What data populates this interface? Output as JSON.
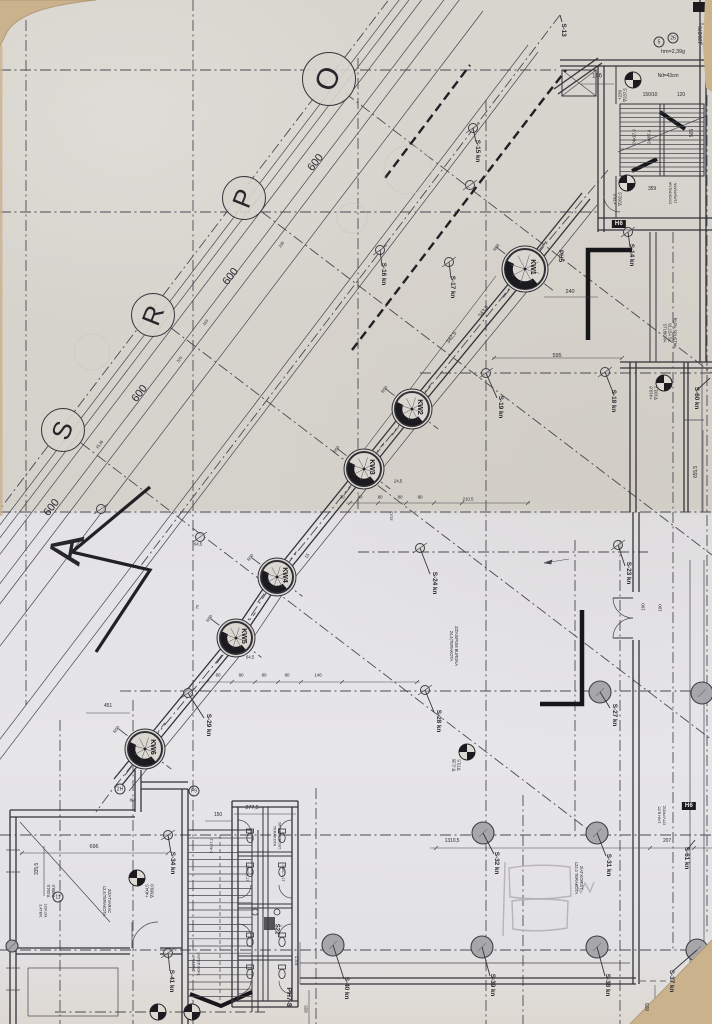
{
  "meta": {
    "sheet": "Scanned architectural working drawing – floor plan with diagonal colonnade"
  },
  "colors": {
    "paper_top": "#d6d3cc",
    "paper_bottom": "#e3e2e5",
    "cardboard": "#c9b28c",
    "ink": "#33333a",
    "ink_light": "#4a4a52",
    "black": "#1b1b1f",
    "gray_fill": "#a7a7ab",
    "pencil": "#b2afb4"
  },
  "grid": {
    "section_letter": "A",
    "spacing_label": "600",
    "bubbles": [
      {
        "letter": "O",
        "x": 329,
        "y": 79,
        "r": 27,
        "fs": 30
      },
      {
        "letter": "P",
        "x": 244,
        "y": 198,
        "r": 22,
        "fs": 26
      },
      {
        "letter": "R",
        "x": 153,
        "y": 315,
        "r": 22,
        "fs": 26
      },
      {
        "letter": "S",
        "x": 63,
        "y": 430,
        "r": 22,
        "fs": 26
      }
    ]
  },
  "columns": [
    {
      "label": "KW1",
      "x": 525,
      "y": 269,
      "r": 23
    },
    {
      "label": "KW2",
      "x": 412,
      "y": 409,
      "r": 20
    },
    {
      "label": "KW3",
      "x": 364,
      "y": 469,
      "r": 20
    },
    {
      "label": "KW4",
      "x": 277,
      "y": 577,
      "r": 19
    },
    {
      "label": "KW5",
      "x": 236,
      "y": 638,
      "r": 19
    },
    {
      "label": "KW6",
      "x": 145,
      "y": 749,
      "r": 20
    }
  ],
  "survey_columns": [
    {
      "x": 483,
      "y": 833
    },
    {
      "x": 597,
      "y": 833
    },
    {
      "x": 482,
      "y": 947
    },
    {
      "x": 597,
      "y": 947
    },
    {
      "x": 697,
      "y": 950
    },
    {
      "x": 333,
      "y": 945
    },
    {
      "x": 600,
      "y": 692
    },
    {
      "x": 702,
      "y": 693
    },
    {
      "x": 12,
      "y": 946,
      "r": 6
    }
  ],
  "nodes": [
    [
      486,
      373
    ],
    [
      605,
      372
    ],
    [
      425,
      690
    ],
    [
      168,
      835
    ],
    [
      168,
      953
    ],
    [
      420,
      548
    ],
    [
      618,
      545
    ],
    [
      188,
      693
    ],
    [
      628,
      232
    ],
    [
      473,
      128
    ],
    [
      380,
      250
    ],
    [
      470,
      185
    ],
    [
      200,
      537
    ],
    [
      101,
      509
    ],
    [
      449,
      262
    ]
  ],
  "level_markers": [
    [
      633,
      80
    ],
    [
      627,
      183
    ],
    [
      664,
      383
    ],
    [
      467,
      752
    ],
    [
      137,
      878
    ],
    [
      158,
      1012
    ],
    [
      192,
      1012
    ],
    [
      689,
      1002
    ]
  ],
  "leaders": [
    [
      605,
      372,
      614,
      395
    ],
    [
      486,
      373,
      497,
      398
    ],
    [
      600,
      692,
      610,
      708
    ],
    [
      425,
      690,
      434,
      712
    ],
    [
      420,
      548,
      430,
      574
    ],
    [
      618,
      545,
      625,
      566
    ],
    [
      188,
      693,
      204,
      718
    ],
    [
      168,
      835,
      171,
      853
    ],
    [
      168,
      953,
      170,
      971
    ],
    [
      597,
      833,
      606,
      856
    ],
    [
      483,
      833,
      494,
      854
    ],
    [
      697,
      950,
      673,
      971
    ],
    [
      597,
      947,
      605,
      976
    ],
    [
      482,
      947,
      490,
      976
    ],
    [
      333,
      945,
      344,
      979
    ],
    [
      710,
      378,
      697,
      390
    ],
    [
      695,
      840,
      687,
      850
    ],
    [
      628,
      232,
      630,
      247
    ],
    [
      473,
      128,
      476,
      142
    ],
    [
      380,
      250,
      382,
      266
    ],
    [
      449,
      262,
      451,
      278
    ],
    [
      560,
      15,
      562,
      22
    ]
  ],
  "stairs": [
    {
      "x1": 620,
      "x2": 704,
      "y1": 108.5,
      "y2": 172,
      "step": 4.5
    },
    {
      "x1": 188,
      "x2": 252,
      "y1": 838,
      "y2": 1000,
      "step": 7.2
    }
  ],
  "fixtures": {
    "wc": [
      [
        250,
        838
      ],
      [
        282,
        838
      ],
      [
        250,
        872
      ],
      [
        282,
        872
      ],
      [
        250,
        942
      ],
      [
        282,
        942
      ],
      [
        250,
        974
      ],
      [
        282,
        974
      ]
    ],
    "sinks": [
      [
        255,
        912
      ],
      [
        277,
        912
      ]
    ]
  },
  "black_labels": [
    {
      "t": "H6",
      "x": 619,
      "y": 224
    },
    {
      "t": "H6",
      "x": 689,
      "y": 806
    }
  ],
  "circled_labels": [
    {
      "t": "5",
      "x": 659,
      "y": 42
    },
    {
      "t": "26",
      "x": 673,
      "y": 38
    },
    {
      "t": "2H",
      "x": 120,
      "y": 789
    },
    {
      "t": "F9",
      "x": 194,
      "y": 791
    },
    {
      "t": "11",
      "x": 58,
      "y": 897
    }
  ],
  "texts": [
    {
      "n": "grid-spacing",
      "t": "600",
      "x": 316,
      "y": 163,
      "r": -52,
      "s": 11
    },
    {
      "n": "grid-spacing",
      "t": "600",
      "x": 231,
      "y": 277,
      "r": -52,
      "s": 11
    },
    {
      "n": "grid-spacing",
      "t": "600",
      "x": 140,
      "y": 394,
      "r": -52,
      "s": 11
    },
    {
      "n": "grid-spacing",
      "t": "600",
      "x": 52,
      "y": 508,
      "r": -52,
      "s": 11
    },
    {
      "n": "dim",
      "t": "146",
      "x": 597,
      "y": 77,
      "r": 0,
      "s": 6
    },
    {
      "n": "dim",
      "t": "150/10",
      "x": 650,
      "y": 96,
      "r": 0,
      "s": 5
    },
    {
      "n": "dim",
      "t": "120",
      "x": 681,
      "y": 96,
      "r": 0,
      "s": 5
    },
    {
      "n": "dim",
      "t": "359",
      "x": 652,
      "y": 190,
      "r": 0,
      "s": 5
    },
    {
      "n": "dim",
      "t": "505",
      "x": 693,
      "y": 133,
      "r": -90,
      "s": 5
    },
    {
      "n": "dim",
      "t": "24x17,9",
      "x": 634,
      "y": 137,
      "r": -90,
      "s": 4.5
    },
    {
      "n": "dim",
      "t": "240/7,4",
      "x": 649,
      "y": 137,
      "r": -90,
      "s": 4.5
    },
    {
      "n": "note",
      "t": "hm=2,39g",
      "x": 673,
      "y": 52,
      "r": 0,
      "s": 5.5
    },
    {
      "n": "note",
      "t": "Nd=43cm",
      "x": 668,
      "y": 77,
      "r": 0,
      "s": 5
    },
    {
      "n": "dim",
      "t": "120/270",
      "x": 702,
      "y": 35,
      "r": -90,
      "s": 5
    },
    {
      "n": "marker-label",
      "t": "S-13",
      "x": 563,
      "y": 30,
      "r": 90,
      "s": 6.5,
      "b": 1
    },
    {
      "n": "marker-label",
      "t": "S-14 kn",
      "x": 631,
      "y": 255,
      "r": 90,
      "s": 6.5,
      "b": 1
    },
    {
      "n": "marker-label",
      "t": "S-15 kn",
      "x": 477,
      "y": 151,
      "r": 90,
      "s": 6.5,
      "b": 1
    },
    {
      "n": "marker-label",
      "t": "S-16 kn",
      "x": 383,
      "y": 274,
      "r": 90,
      "s": 6.5,
      "b": 1
    },
    {
      "n": "marker-label",
      "t": "S-17 kn",
      "x": 452,
      "y": 287,
      "r": 90,
      "s": 6.5,
      "b": 1
    },
    {
      "n": "marker-label",
      "t": "S-18 kn",
      "x": 613,
      "y": 401,
      "r": 90,
      "s": 6.5,
      "b": 1
    },
    {
      "n": "marker-label",
      "t": "S-19 kn",
      "x": 500,
      "y": 407,
      "r": 90,
      "s": 6.5,
      "b": 1
    },
    {
      "n": "marker-label",
      "t": "S-23 kn",
      "x": 628,
      "y": 573,
      "r": 90,
      "s": 6.5,
      "b": 1
    },
    {
      "n": "marker-label",
      "t": "S-24 kn",
      "x": 434,
      "y": 583,
      "r": 90,
      "s": 6.5,
      "b": 1
    },
    {
      "n": "marker-label",
      "t": "S-27 kn",
      "x": 614,
      "y": 715,
      "r": 90,
      "s": 6.5,
      "b": 1
    },
    {
      "n": "marker-label",
      "t": "S-28 kn",
      "x": 438,
      "y": 721,
      "r": 90,
      "s": 6.5,
      "b": 1
    },
    {
      "n": "marker-label",
      "t": "S-29 kn",
      "x": 208,
      "y": 725,
      "r": 90,
      "s": 6.5,
      "b": 1
    },
    {
      "n": "marker-label",
      "t": "S-31 kn",
      "x": 608,
      "y": 865,
      "r": 90,
      "s": 6.5,
      "b": 1
    },
    {
      "n": "marker-label",
      "t": "S-32 kn",
      "x": 496,
      "y": 863,
      "r": 90,
      "s": 6.5,
      "b": 1
    },
    {
      "n": "marker-label",
      "t": "S-34 kn",
      "x": 172,
      "y": 863,
      "r": 90,
      "s": 6.5,
      "b": 1
    },
    {
      "n": "marker-label",
      "t": "S-37 kn",
      "x": 671,
      "y": 981,
      "r": 90,
      "s": 6.5,
      "b": 1
    },
    {
      "n": "marker-label",
      "t": "S-38 kn",
      "x": 607,
      "y": 985,
      "r": 90,
      "s": 6.5,
      "b": 1
    },
    {
      "n": "marker-label",
      "t": "S-39 kn",
      "x": 492,
      "y": 985,
      "r": 90,
      "s": 6.5,
      "b": 1
    },
    {
      "n": "marker-label",
      "t": "S-40 kn",
      "x": 346,
      "y": 988,
      "r": 90,
      "s": 6.5,
      "b": 1
    },
    {
      "n": "marker-label",
      "t": "S-41 kn",
      "x": 171,
      "y": 981,
      "r": 90,
      "s": 6.5,
      "b": 1
    },
    {
      "n": "marker-label",
      "t": "S-60 kn",
      "x": 696,
      "y": 398,
      "r": 90,
      "s": 6.5,
      "b": 1
    },
    {
      "n": "marker-label",
      "t": "S-61 kn",
      "x": 686,
      "y": 858,
      "r": 90,
      "s": 6.5,
      "b": 1
    },
    {
      "n": "label",
      "t": "PH5",
      "x": 560,
      "y": 256,
      "r": 90,
      "s": 6.5,
      "b": 1
    },
    {
      "n": "label",
      "t": "PH7-8",
      "x": 288,
      "y": 997,
      "r": 90,
      "s": 7,
      "b": 1
    },
    {
      "n": "label",
      "t": "Š22",
      "x": 276,
      "y": 929,
      "r": 90,
      "s": 6,
      "b": 1
    },
    {
      "n": "dim",
      "t": "277,5",
      "x": 252,
      "y": 808,
      "r": 0,
      "s": 5.5
    },
    {
      "n": "dim",
      "t": "696",
      "x": 94,
      "y": 847,
      "r": 0,
      "s": 5.5
    },
    {
      "n": "dim",
      "t": "335,5",
      "x": 38,
      "y": 869,
      "r": -90,
      "s": 5
    },
    {
      "n": "dim",
      "t": "451",
      "x": 108,
      "y": 707,
      "r": 0,
      "s": 5
    },
    {
      "n": "level-text",
      "t": "+404,5\n∇389,0",
      "x": 150,
      "y": 891,
      "r": -90,
      "s": 4.5
    },
    {
      "n": "note",
      "t": "2/ZATVARAC\n12,4(TERAKOTA",
      "x": 106,
      "y": 901,
      "r": 90,
      "s": 4.2
    },
    {
      "n": "note",
      "t": "2/ZASIPOM BURONA\n24,4(TERAKOTA",
      "x": 453,
      "y": 646,
      "r": 90,
      "s": 4.2
    },
    {
      "n": "note",
      "t": "2/AT.KORIŠT.\n122,4 TERAKOTA",
      "x": 578,
      "y": 878,
      "r": 90,
      "s": 4.2
    },
    {
      "n": "note",
      "t": "RUPA SPUSTNA\n91,15A SL.\nSTUBOVA",
      "x": 669,
      "y": 333,
      "r": 90,
      "s": 4.2
    },
    {
      "n": "level-text",
      "t": "+239\n∇237,5",
      "x": 623,
      "y": 95,
      "r": -90,
      "s": 4.5
    },
    {
      "n": "level-text",
      "t": "+78,6\n∇202,5",
      "x": 618,
      "y": 199,
      "r": -90,
      "s": 4.5
    },
    {
      "n": "level-text",
      "t": "+410,8\n∇103,7",
      "x": 654,
      "y": 393,
      "r": -90,
      "s": 4.5
    },
    {
      "n": "level-text",
      "t": "∇-2,35\n∇73,5",
      "x": 457,
      "y": 765,
      "r": -90,
      "s": 4.5
    },
    {
      "n": "dim",
      "t": "1310,5",
      "x": 452,
      "y": 842,
      "r": 0,
      "s": 5
    },
    {
      "n": "dim",
      "t": "207",
      "x": 667,
      "y": 842,
      "r": 0,
      "s": 5
    },
    {
      "n": "dim",
      "t": "605",
      "x": 649,
      "y": 1007,
      "r": -90,
      "s": 5
    },
    {
      "n": "dim",
      "t": "655,5",
      "x": 697,
      "y": 472,
      "r": -90,
      "s": 5
    },
    {
      "n": "dim",
      "t": "595",
      "x": 557,
      "y": 356,
      "r": 0,
      "s": 5.5
    },
    {
      "n": "dim",
      "t": "240",
      "x": 570,
      "y": 292,
      "r": 0,
      "s": 5.5
    },
    {
      "n": "dim",
      "t": "342,5",
      "x": 452,
      "y": 338,
      "r": -52,
      "s": 5.5
    },
    {
      "n": "dim",
      "t": "343,5",
      "x": 484,
      "y": 312,
      "r": -52,
      "s": 5.5
    },
    {
      "n": "dim",
      "t": "30",
      "x": 342,
      "y": 497,
      "r": 0,
      "s": 4.5
    },
    {
      "n": "dim",
      "t": "80",
      "x": 360,
      "y": 497,
      "r": 0,
      "s": 4.5
    },
    {
      "n": "dim",
      "t": "80",
      "x": 380,
      "y": 497,
      "r": 0,
      "s": 4.5
    },
    {
      "n": "dim",
      "t": "80",
      "x": 400,
      "y": 497,
      "r": 0,
      "s": 4.5
    },
    {
      "n": "dim",
      "t": "80",
      "x": 420,
      "y": 497,
      "r": 0,
      "s": 4.5
    },
    {
      "n": "dim",
      "t": "210,5",
      "x": 468,
      "y": 499,
      "r": 0,
      "s": 4.5
    },
    {
      "n": "dim",
      "t": "24,5",
      "x": 398,
      "y": 481,
      "r": 0,
      "s": 4.5
    },
    {
      "n": "dim",
      "t": "313,5",
      "x": 392,
      "y": 516,
      "r": -90,
      "s": 4
    },
    {
      "n": "dim",
      "t": "80",
      "x": 218,
      "y": 675,
      "r": 0,
      "s": 4.5
    },
    {
      "n": "dim",
      "t": "80",
      "x": 241,
      "y": 675,
      "r": 0,
      "s": 4.5
    },
    {
      "n": "dim",
      "t": "80",
      "x": 264,
      "y": 675,
      "r": 0,
      "s": 4.5
    },
    {
      "n": "dim",
      "t": "80",
      "x": 287,
      "y": 675,
      "r": 0,
      "s": 4.5
    },
    {
      "n": "dim",
      "t": "146",
      "x": 318,
      "y": 675,
      "r": 0,
      "s": 4.5
    },
    {
      "n": "dim",
      "t": "64,5",
      "x": 250,
      "y": 657,
      "r": 0,
      "s": 4.5
    },
    {
      "n": "dim",
      "t": "64,5",
      "x": 198,
      "y": 544,
      "r": 0,
      "s": 4.5
    },
    {
      "n": "dim",
      "t": "70",
      "x": 198,
      "y": 607,
      "r": -90,
      "s": 4
    },
    {
      "n": "dim",
      "t": "15",
      "x": 307,
      "y": 556,
      "r": -52,
      "s": 4.5
    },
    {
      "n": "dim",
      "t": "150",
      "x": 218,
      "y": 816,
      "r": 0,
      "s": 5
    },
    {
      "n": "dim",
      "t": "2-4x17,1",
      "x": 212,
      "y": 846,
      "r": -90,
      "s": 4
    },
    {
      "n": "note",
      "t": "1/STEP.SOKL\n14,4 PVC",
      "x": 196,
      "y": 964,
      "r": 90,
      "s": 4
    },
    {
      "n": "dim",
      "t": "163",
      "x": 206,
      "y": 323,
      "r": -52,
      "s": 4
    },
    {
      "n": "dim",
      "t": "235",
      "x": 282,
      "y": 245,
      "r": -52,
      "s": 4
    },
    {
      "n": "dim",
      "t": "370",
      "x": 180,
      "y": 360,
      "r": -52,
      "s": 4
    },
    {
      "n": "dim",
      "t": "15,35",
      "x": 100,
      "y": 445,
      "r": -52,
      "s": 4
    },
    {
      "n": "note",
      "t": "2/PREDPROST.\nTERAKOTA",
      "x": 277,
      "y": 836,
      "r": 90,
      "s": 4
    },
    {
      "n": "note",
      "t": "1/WC 1,1T",
      "x": 247,
      "y": 873,
      "r": 90,
      "s": 3.8
    },
    {
      "n": "note",
      "t": "1/WC 1,1T",
      "x": 283,
      "y": 873,
      "r": 90,
      "s": 3.8
    },
    {
      "n": "level-text",
      "t": "∇454,5\n∇389,0",
      "x": 52,
      "y": 891,
      "r": -90,
      "s": 4.2
    },
    {
      "n": "note",
      "t": "1/2KUH.\n3,4TER.",
      "x": 43,
      "y": 911,
      "r": 90,
      "s": 4
    },
    {
      "n": "note",
      "t": "1/4H B,55\nOTV.PROZ.",
      "x": 662,
      "y": 815,
      "r": -90,
      "s": 4
    },
    {
      "n": "note",
      "t": "DVOKRILNA\n(1/4)VRATA",
      "x": 673,
      "y": 193,
      "r": -90,
      "s": 4
    },
    {
      "n": "dim",
      "t": "100",
      "x": 643,
      "y": 607,
      "r": -90,
      "s": 4.5
    },
    {
      "n": "dim",
      "t": "100",
      "x": 660,
      "y": 608,
      "r": -90,
      "s": 4.5
    },
    {
      "n": "dim",
      "t": "80",
      "x": 132,
      "y": 800,
      "r": 0,
      "s": 4.5
    },
    {
      "n": "dim",
      "t": "825",
      "x": 306,
      "y": 1009,
      "r": -90,
      "s": 4.5
    },
    {
      "n": "dim",
      "t": "302,5",
      "x": 297,
      "y": 961,
      "r": -90,
      "s": 4
    },
    {
      "n": "dim",
      "t": "R50",
      "x": 497,
      "y": 248,
      "r": -52,
      "s": 4.2
    },
    {
      "n": "dim",
      "t": "R50",
      "x": 385,
      "y": 390,
      "r": -52,
      "s": 4.2
    },
    {
      "n": "dim",
      "t": "R50",
      "x": 337,
      "y": 450,
      "r": -52,
      "s": 4.2
    },
    {
      "n": "dim",
      "t": "R50",
      "x": 251,
      "y": 558,
      "r": -52,
      "s": 4.2
    },
    {
      "n": "dim",
      "t": "R50",
      "x": 210,
      "y": 619,
      "r": -52,
      "s": 4.2
    },
    {
      "n": "dim",
      "t": "R50",
      "x": 117,
      "y": 730,
      "r": -52,
      "s": 4.2
    }
  ]
}
